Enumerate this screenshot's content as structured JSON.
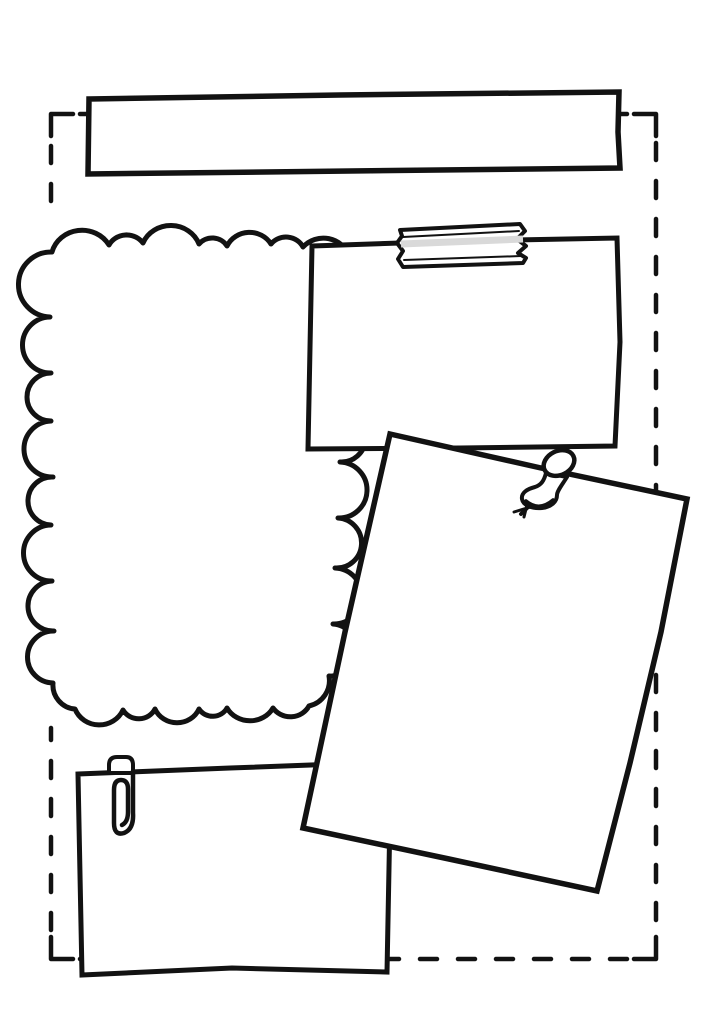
{
  "page": {
    "background": "#ffffff",
    "ink": "#121212"
  },
  "border": {
    "dash_pattern": "17 21"
  },
  "banner": {
    "label": ""
  },
  "notes": {
    "cloud_frame": {
      "content": ""
    },
    "taped_note": {
      "content": "",
      "tape_tint": "#d9d9d9"
    },
    "pinned_note": {
      "content": ""
    },
    "clipped_note": {
      "content": ""
    }
  },
  "icons": {
    "tape": "washi-tape-icon",
    "pin": "pushpin-icon",
    "clip": "paperclip-icon"
  }
}
